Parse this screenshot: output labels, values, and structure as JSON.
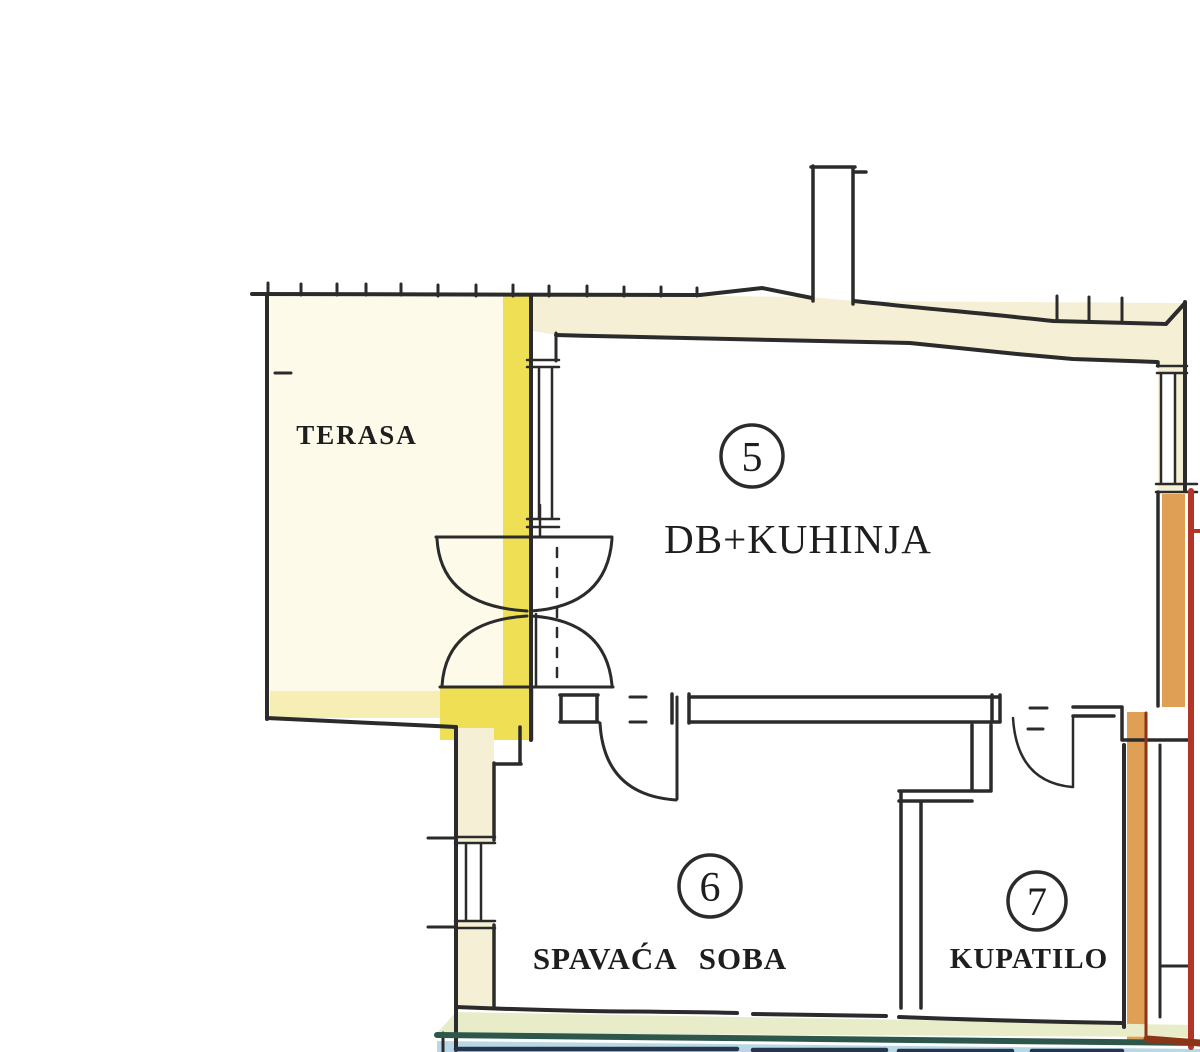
{
  "plan": {
    "title": "apartment floor plan",
    "rooms": {
      "terrace": {
        "label": "TERASA"
      },
      "living": {
        "number": "5",
        "label": "DB+KUHINJA"
      },
      "bedroom": {
        "number": "6",
        "label": "SPAVAĆA SOBA"
      },
      "bathroom": {
        "number": "7",
        "label": "KUPATILO"
      }
    },
    "colors": {
      "wall_line": "#2b2b2b",
      "terrace_highlight": "#efdf55",
      "terrace_highlight_pale": "#f6eeb4",
      "terrace_wash": "#fdfaea",
      "wall_fill": "#f5efd5",
      "window_fill": "#ffffff",
      "neighbor_orange": "#dfa055",
      "neighbor_maroon": "#8a3418",
      "neighbor_red": "#b23527",
      "lower_teal": "#2d574b",
      "lower_blue_band": "#b9d8e6",
      "lower_dark_blue": "#24364e",
      "bottom_wall_fill": "#e9ecc8"
    }
  }
}
